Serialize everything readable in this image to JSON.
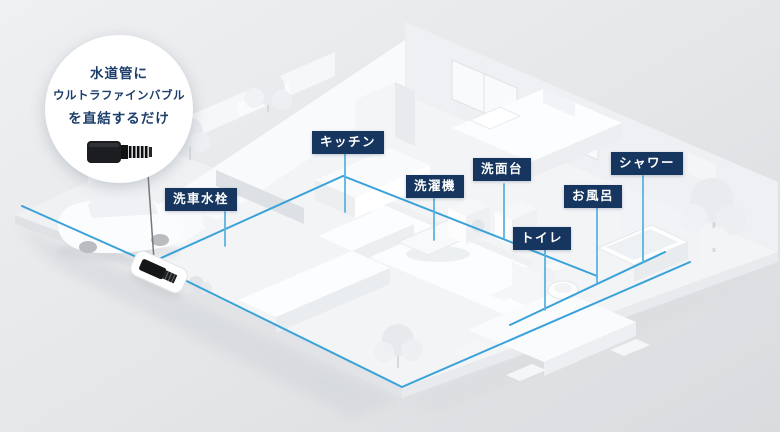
{
  "callout": {
    "line1": "水道管に",
    "line2": "ウルトラファインバブル",
    "line3": "を直結するだけ"
  },
  "labels": [
    {
      "id": "car-wash-faucet",
      "text": "洗車水栓"
    },
    {
      "id": "kitchen",
      "text": "キッチン"
    },
    {
      "id": "washing-machine",
      "text": "洗濯機"
    },
    {
      "id": "washbasin",
      "text": "洗面台"
    },
    {
      "id": "shower",
      "text": "シャワー"
    },
    {
      "id": "bath",
      "text": "お風呂"
    },
    {
      "id": "toilet",
      "text": "トイレ"
    }
  ],
  "colors": {
    "label_bg": "#16365f",
    "label_text": "#ffffff",
    "pipe_line": "#3aa2d9",
    "callout_bg": "#ffffff",
    "callout_text": "#1d3e6b",
    "background_top": "#eef0f2",
    "background_bottom": "#d9dbde"
  },
  "icons": {
    "connector_device": "ultra-fine-bubble-connector-icon"
  }
}
